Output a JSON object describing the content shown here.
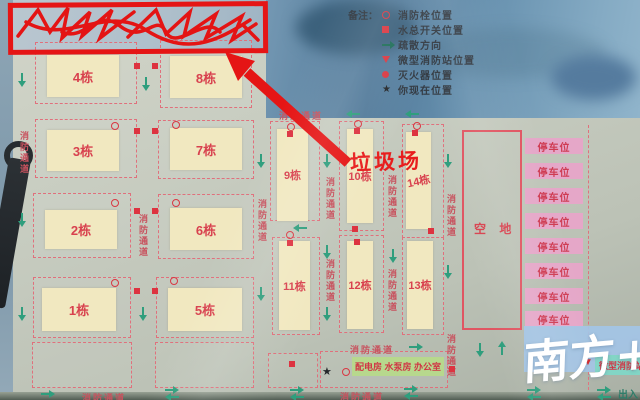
{
  "map": {
    "road_label": "消防通道",
    "building_labels": [
      "1栋",
      "2栋",
      "3栋",
      "4栋",
      "5栋",
      "6栋",
      "7栋",
      "8栋",
      "9栋",
      "10栋",
      "11栋",
      "12栋",
      "13栋",
      "14栋"
    ],
    "empty_lot_label": "空 地",
    "parking_label": "停车位",
    "facility_label": "配电房 水泵房 办公室",
    "micro_station_label": "微型消防站",
    "entrance_label": "出入",
    "garbage_annotation": "垃圾场"
  },
  "legend": {
    "prefix": "备注：",
    "items": [
      {
        "icon": "hydrant-circle",
        "label": "消防栓位置"
      },
      {
        "icon": "red-square",
        "label": "水总开关位置"
      },
      {
        "icon": "green-arrow",
        "label": "疏散方向"
      },
      {
        "icon": "red-triangle",
        "label": "微型消防站位置"
      },
      {
        "icon": "red-dot",
        "label": "灭火器位置"
      },
      {
        "icon": "black-star",
        "label": "你现在位置"
      }
    ]
  },
  "icons": {
    "star": "★",
    "triangle_down": "▼"
  },
  "watermark": "南方+",
  "colors": {
    "accent_red": "#e02828",
    "road_text_red": "#c8525e",
    "building_cream": "#f1e8c0",
    "arrow_teal": "#2f9e7d",
    "parking_pink": "#e5a7c8",
    "facility_green": "#b7d88d",
    "station_teal": "#83d5c5",
    "watermark_blue": "#a3c4e6"
  }
}
